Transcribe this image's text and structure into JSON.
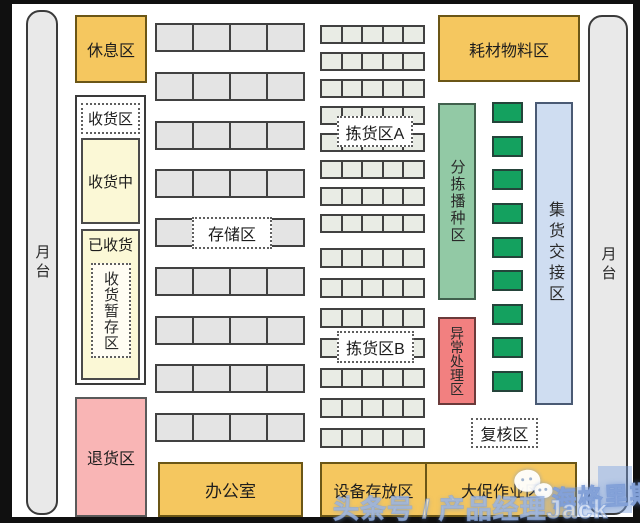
{
  "zones": {
    "dock_left": "月台",
    "dock_right": "月台",
    "rest": "休息区",
    "receiving": "收货区",
    "receiving_in_progress": "收货中",
    "received": "已收货",
    "receiving_staging": "收货暂存区",
    "returns": "退货区",
    "storage": "存储区",
    "picking_a": "拣货区A",
    "picking_b": "拣货区B",
    "consumables": "耗材物料区",
    "sorting_seeding": "分拣播种区",
    "exception": "异常处理区",
    "consolidation": "集货交接区",
    "review": "复核区",
    "office": "办公室",
    "equipment": "设备存放区",
    "promo": "大促作业区"
  },
  "grids": {
    "storage": {
      "rows": 9,
      "cols": 4
    },
    "picking_a": {
      "rows": 8,
      "cols": 5
    },
    "picking_b": {
      "rows": 7,
      "cols": 5
    },
    "sorting_slots": {
      "count": 9
    }
  },
  "watermark": {
    "line": "头条号 / 产品经理Jack",
    "brand": "海格里斯",
    "icon": "wechat-logo"
  },
  "colors": {
    "orange": "#f5c75f",
    "pale_yellow": "#fbf8d6",
    "pink": "#f9b5b5",
    "red": "#f28080",
    "green_bar": "#92c9a5",
    "green_slot": "#14a15f",
    "blue_bar": "#cfddf1",
    "shelf_gray": "#e4e4e4",
    "picking_gray": "#e9ece5",
    "frame_black": "#101010"
  }
}
